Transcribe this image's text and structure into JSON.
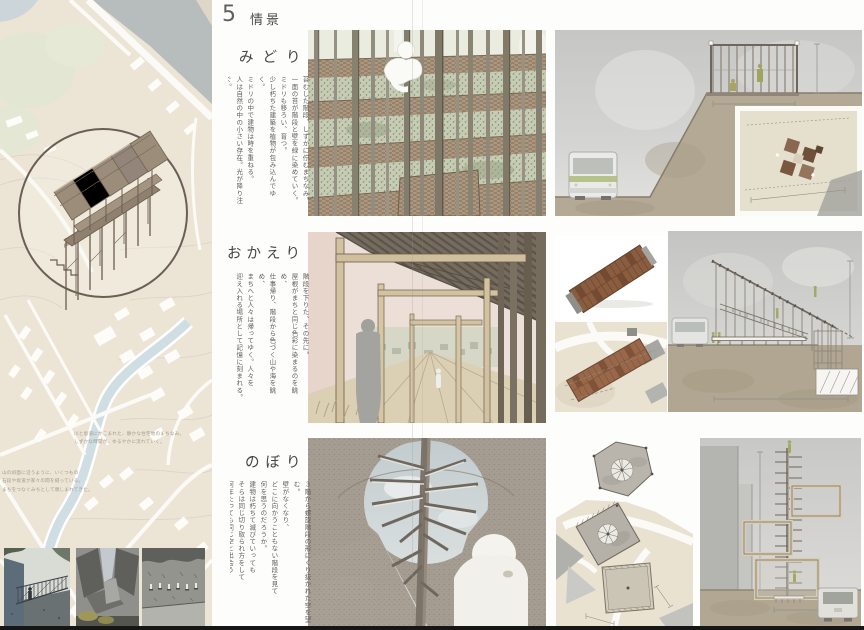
{
  "page": {
    "header": {
      "number": "5",
      "title": "情景"
    },
    "sections": [
      {
        "id": "midori",
        "title": "みどり",
        "lines": [
          "苔むした階段、しずかに佇むまちなみ。",
          "一面の苔が階段と壁を緑に染めていく。",
          "ミドリも移ろい、育つ。",
          "少し朽ちた建築を植物が包み込んでゆく。",
          "ミドリの中で建物は時を重ねる。",
          "人は自然の中の小さい存在。光が降り注ぐ。"
        ]
      },
      {
        "id": "okaeri",
        "title": "おかえり",
        "lines": [
          "階段を下りた、その先に。",
          "屋根がまちと同じ色彩に染まるのを眺め、",
          "仕事帰り、階段から色づく山や海を眺め、",
          "まちへと人々は帰ってゆく。人々を",
          "迎え入れる場所として記憶に刻まれる。"
        ]
      },
      {
        "id": "nobori",
        "title": "のぼり",
        "lines": [
          "３階から螺旋階段の形にくり抜かれた空を望む。",
          "壁がなくなり、",
          "どこに向かうこともない階段を見て",
          "何を思うのだろうか。",
          "建物は朽ちて滅びていっても",
          "そらは同じ切り取られ方をして",
          "何年たっても同じ空と出会う"
        ]
      }
    ],
    "map_notes": [
      {
        "lines": [
          "川と坂道にかこまれた、静かな住宅地のまちなみ。",
          "しずかな時間が、ゆるやかに流れていく。"
        ]
      },
      {
        "lines": [
          "山の斜面に沿うように、いくつもの",
          "石段や坂道が家々の間を縫っている。",
          "まちをつなぐみちとして親しまれてきた。"
        ]
      }
    ],
    "colors": {
      "map_beige": "#ece4d5",
      "river_blue": "#cfdee3",
      "water_gray": "#b7bcbc",
      "wood_brown": "#9a8a78",
      "moss_green": "#c6cdb4",
      "roof_brown": "#8a5c40",
      "ground_taupe": "#b3a994",
      "figure_green": "#a4aa62",
      "footer_black": "#161616"
    }
  }
}
